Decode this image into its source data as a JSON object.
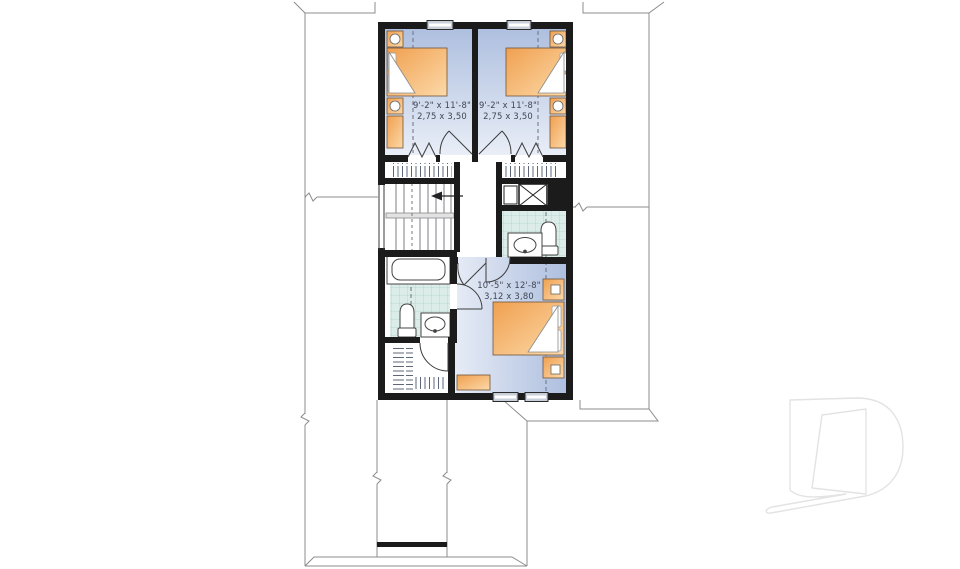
{
  "plan": {
    "kind": "residential-second-floor-plan",
    "rooms": {
      "bedroom_left": {
        "dim_ft": "9'-2\" x 11'-8\"",
        "dim_m": "2,75 x 3,50"
      },
      "bedroom_right": {
        "dim_ft": "9'-2\" x 11'-8\"",
        "dim_m": "2,75 x 3,50"
      },
      "master_bedroom": {
        "dim_ft": "10'-5\" x 12'-8\"",
        "dim_m": "3,12 x 3,80"
      }
    },
    "stairs": {
      "direction_arrow": "left"
    },
    "fixture_icons": [
      "bed-icon",
      "nightstand-icon",
      "dresser-icon",
      "bathtub-icon",
      "toilet-icon",
      "sink-vanity-icon",
      "closet-hanging-rods-icon",
      "attic-shaft-icon",
      "bifold-door-icon",
      "door-swing-icon",
      "window-icon",
      "roof-outline-icon",
      "break-mark-icon"
    ],
    "colors": {
      "wall": "#1b1b1b",
      "floor_blue_dark": "#aebfdf",
      "floor_blue_light": "#e9eef7",
      "furniture_orange_dark": "#f0a050",
      "furniture_orange_light": "#fcd9a8",
      "tile_base": "#dcece8",
      "tile_line": "#aed5cc",
      "roof_line": "#8c8c8c",
      "watermark": "#e3e3e3"
    }
  },
  "watermark": {
    "name": "builder-d-logo"
  }
}
